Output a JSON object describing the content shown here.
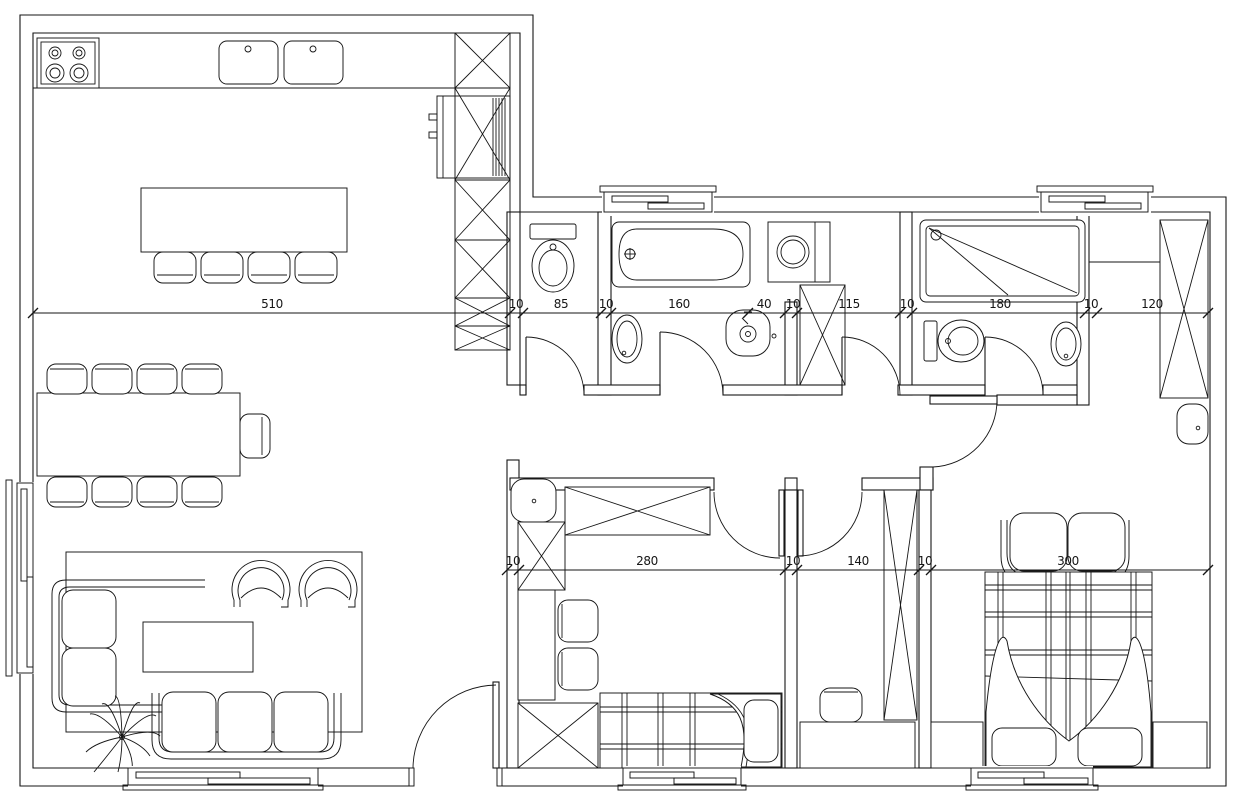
{
  "drawing": {
    "type": "apartment-floor-plan",
    "style": "cad-blackline",
    "line_color": "#161616",
    "background": "#ffffff"
  },
  "dims": {
    "upper": [
      "510",
      "10",
      "85",
      "10",
      "160",
      "40",
      "10",
      "115",
      "10",
      "180",
      "10",
      "120"
    ],
    "lower": [
      "10",
      "280",
      "10",
      "140",
      "10",
      "300"
    ]
  }
}
